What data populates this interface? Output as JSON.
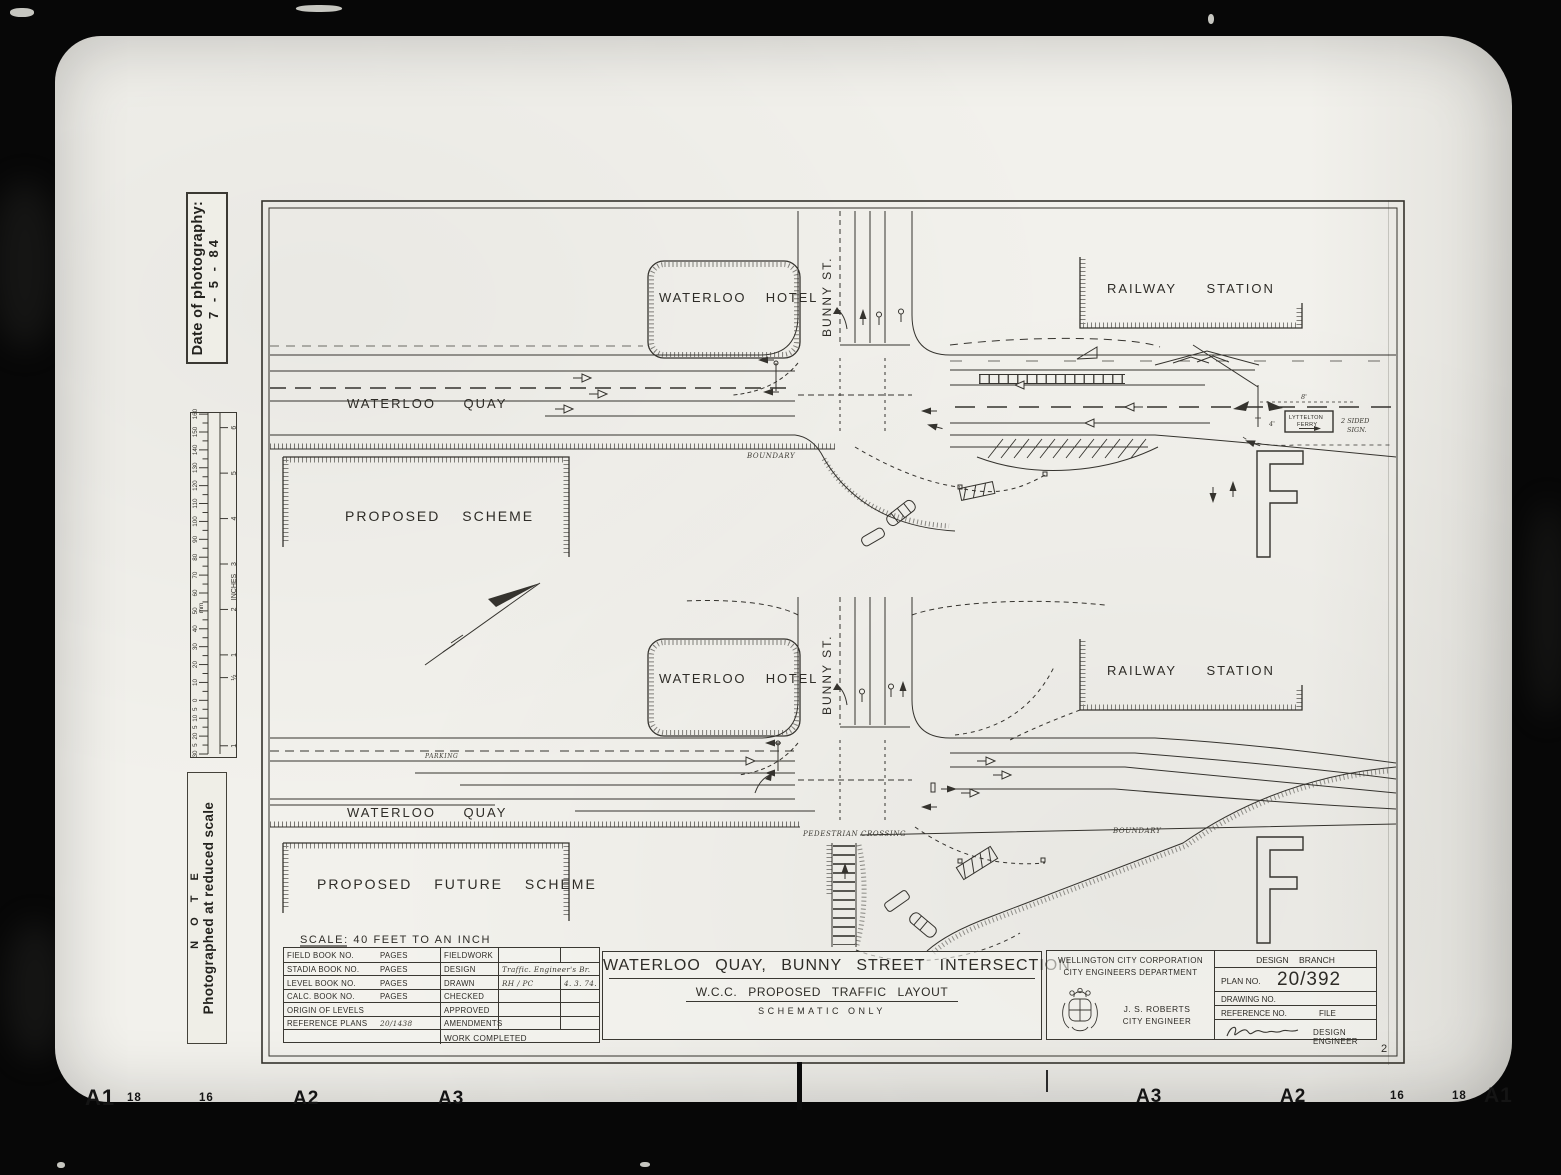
{
  "film": {
    "bottom_marks": [
      "A1",
      "18",
      "16",
      "A2",
      "A3",
      "A3",
      "A2",
      "16",
      "18",
      "A1"
    ]
  },
  "margin": {
    "date_label": "Date of photography:",
    "date_value": "7 - 5 - 84",
    "note_title": "N O T E",
    "note_text": "Photographed at reduced scale",
    "ruler": {
      "unit_mm": "mm",
      "unit_inches": "INCHES",
      "mm_step": 10,
      "mm_max": 160,
      "neg_ticks": [
        {
          "mm": -5,
          "t": "5"
        },
        {
          "mm": -10,
          "t": "10"
        },
        {
          "mm": -15,
          "t": "5"
        },
        {
          "mm": -20,
          "t": "20"
        },
        {
          "mm": -25,
          "t": "5"
        },
        {
          "mm": -30,
          "t": "30"
        }
      ],
      "inch_ticks": [
        {
          "inch": 6,
          "t": "6"
        },
        {
          "inch": 5,
          "t": "5"
        },
        {
          "inch": 4,
          "t": "4"
        },
        {
          "inch": 3,
          "t": "3"
        },
        {
          "inch": 2,
          "t": "2"
        },
        {
          "inch": 1,
          "t": "1"
        },
        {
          "inch": 0.5,
          "t": "½"
        },
        {
          "inch": -1,
          "t": "1"
        }
      ]
    }
  },
  "drawing": {
    "scheme_top": {
      "title": "PROPOSED SCHEME",
      "hotel": "WATERLOO HOTEL",
      "street": "BUNNY ST.",
      "station": "RAILWAY STATION",
      "quay": "WATERLOO QUAY",
      "boundary": "BOUNDARY",
      "ferry_line1": "LYTTELTON",
      "ferry_line2": "FERRY",
      "sign_note1": "2 SIDED",
      "sign_note2": "SIGN.",
      "dim_a": "8'",
      "dim_b": "4'"
    },
    "scheme_bottom": {
      "title": "PROPOSED FUTURE SCHEME",
      "hotel": "WATERLOO HOTEL",
      "street": "BUNNY ST.",
      "station": "RAILWAY STATION",
      "quay": "WATERLOO QUAY",
      "boundary": "BOUNDARY",
      "parking": "PARKING",
      "crossing": "PEDESTRIAN CROSSING"
    },
    "scale_note": "SCALE: 40 FEET TO AN INCH",
    "sheet_no": "2"
  },
  "titleblock": {
    "rows": [
      {
        "label": "FIELD BOOK NO.",
        "pages": "PAGES",
        "col2": "FIELDWORK",
        "val": "",
        "val2": ""
      },
      {
        "label": "STADIA BOOK NO.",
        "pages": "PAGES",
        "col2": "DESIGN",
        "val": "Traffic. Engineer's Br.",
        "val2": ""
      },
      {
        "label": "LEVEL BOOK NO.",
        "pages": "PAGES",
        "col2": "DRAWN",
        "val": "RH / PC",
        "val2": "4. 3. 74."
      },
      {
        "label": "CALC. BOOK NO.",
        "pages": "PAGES",
        "col2": "CHECKED",
        "val": "",
        "val2": ""
      },
      {
        "label": "ORIGIN OF LEVELS",
        "pages": "",
        "col2": "APPROVED",
        "val": "",
        "val2": ""
      },
      {
        "label": "REFERENCE PLANS",
        "pages": "20/1438",
        "col2": "AMENDMENTS",
        "val": "",
        "val2": ""
      }
    ],
    "work_completed": "WORK COMPLETED",
    "center": {
      "title": "WATERLOO QUAY, BUNNY STREET INTERSECTION",
      "subtitle": "W.C.C. PROPOSED TRAFFIC LAYOUT",
      "note": "SCHEMATIC ONLY"
    },
    "right": {
      "org1": "WELLINGTON CITY CORPORATION",
      "org2": "CITY ENGINEERS DEPARTMENT",
      "name": "J. S. ROBERTS",
      "name_title": "CITY ENGINEER",
      "branch": "DESIGN BRANCH",
      "plan_label": "PLAN NO.",
      "plan_no": "20/392",
      "drawing_label": "DRAWING NO.",
      "ref_label": "REFERENCE NO.",
      "file_label": "FILE",
      "design_engineer": "DESIGN ENGINEER"
    }
  }
}
